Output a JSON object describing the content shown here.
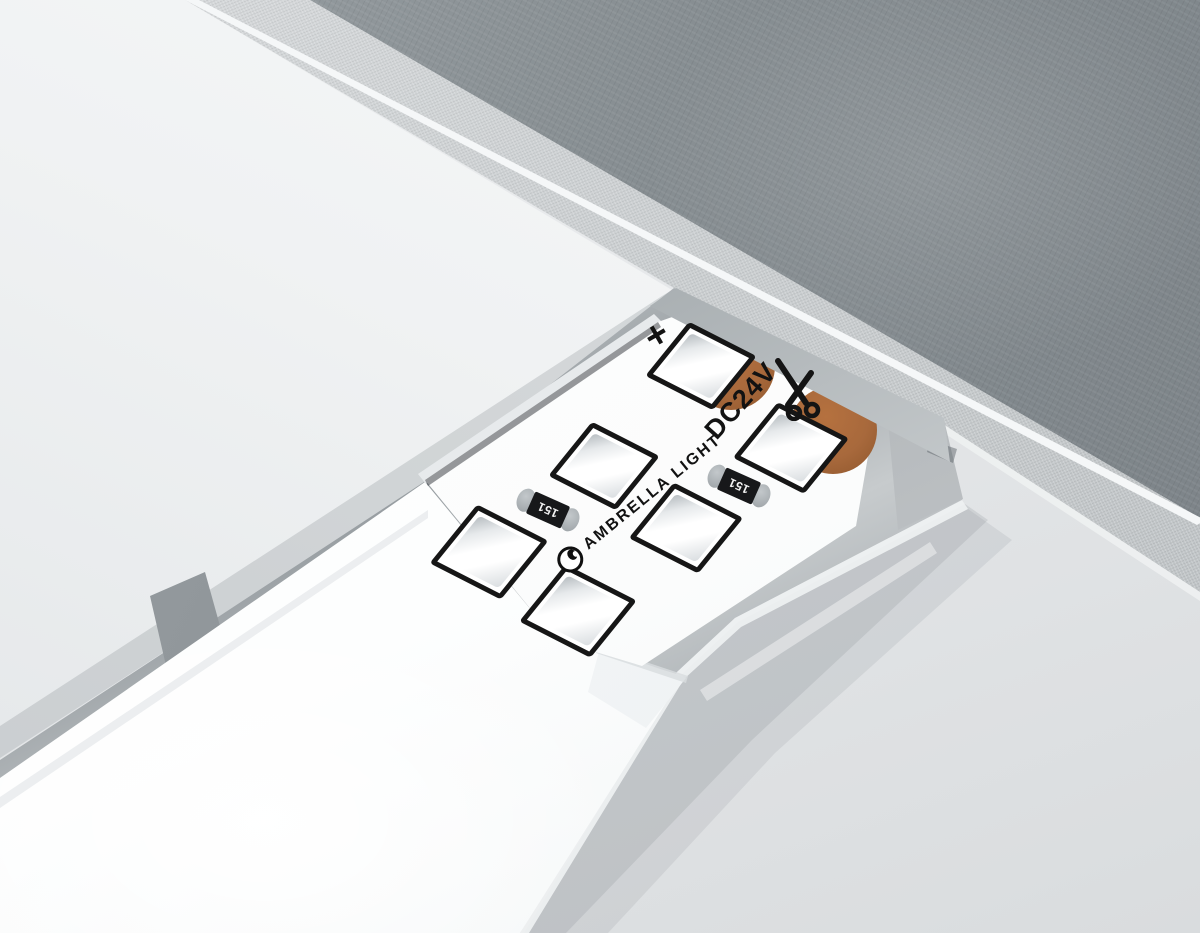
{
  "meta": {
    "description": "3D render of a recessed aluminium LED profile in a ceiling niche against a concrete wall, diffuser cover slid back to expose the LED strip"
  },
  "colors": {
    "wall": "#e4e6e8",
    "ceiling": "#f2f4f5",
    "concrete": "#868d91",
    "plaster": "#c6cacc",
    "aluminum": "#b5babd",
    "diffuser": "#fcfdfe",
    "pcb": "#fdfdfd",
    "silkscreen": "#121212",
    "copper": "#a8693c",
    "copper-light": "#b5713f",
    "copper-dark": "#8e562c"
  },
  "strip": {
    "brand_label": "AMBRELLA LIGHT",
    "voltage_label": "DC24V",
    "polarity_plus_label": "+",
    "resistor_label": "151",
    "icons": [
      "scissors-icon",
      "brand-logo-icon"
    ],
    "labels": {
      "plus": {
        "x": 657,
        "y": 336,
        "rot": -30
      },
      "voltage": {
        "x": 741,
        "y": 401,
        "rot": -48
      },
      "brand": {
        "x": 640,
        "y": 503,
        "rot": -39
      },
      "scissors": {
        "x": 795,
        "y": 389,
        "rot": 0
      }
    },
    "leds": [
      {
        "x": 701,
        "y": 366,
        "w": 76,
        "h": 68
      },
      {
        "x": 791,
        "y": 448,
        "w": 80,
        "h": 70
      },
      {
        "x": 604,
        "y": 466,
        "w": 76,
        "h": 68
      },
      {
        "x": 489,
        "y": 552,
        "w": 80,
        "h": 74
      },
      {
        "x": 686,
        "y": 528,
        "w": 78,
        "h": 70
      },
      {
        "x": 578,
        "y": 611,
        "w": 80,
        "h": 72
      }
    ],
    "resistors": [
      {
        "x": 546,
        "y": 511
      },
      {
        "x": 737,
        "y": 487
      }
    ],
    "solder_pads": [
      {
        "x": 731,
        "y": 366,
        "d": 88
      },
      {
        "x": 833,
        "y": 430,
        "d": 88
      }
    ]
  }
}
